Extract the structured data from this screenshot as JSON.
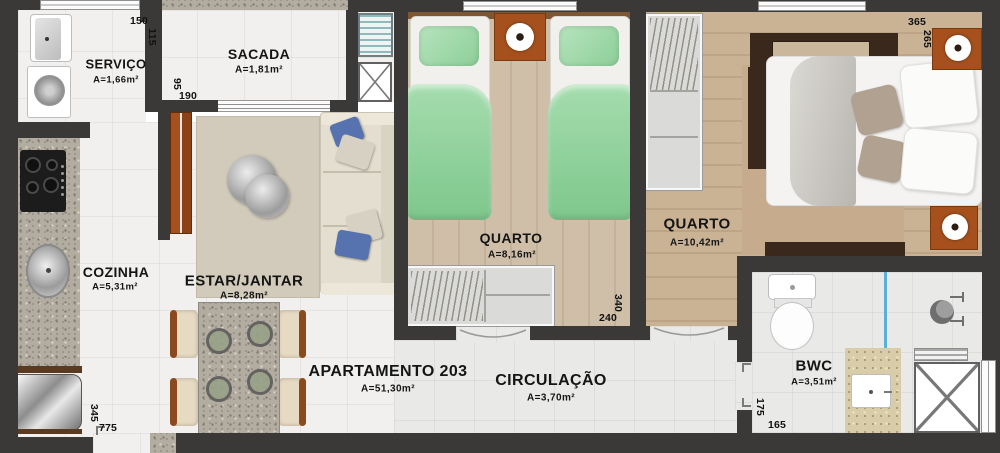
{
  "rooms": {
    "servico": {
      "name": "SERVIÇO",
      "area": "A=1,66m²"
    },
    "sacada": {
      "name": "SACADA",
      "area": "A=1,81m²"
    },
    "cozinha": {
      "name": "COZINHA",
      "area": "A=5,31m²"
    },
    "estar_jantar": {
      "name": "ESTAR/JANTAR",
      "area": "A=8,28m²"
    },
    "quarto1": {
      "name": "QUARTO",
      "area": "A=8,16m²"
    },
    "quarto2": {
      "name": "QUARTO",
      "area": "A=10,42m²"
    },
    "apartamento": {
      "name": "APARTAMENTO 203",
      "area": "A=51,30m²"
    },
    "circulacao": {
      "name": "CIRCULAÇÃO",
      "area": "A=3,70m²"
    },
    "bwc": {
      "name": "BWC",
      "area": "A=3,51m²"
    }
  },
  "dimensions_cm": {
    "servico_width": "150",
    "servico_height": "115",
    "sacada_height": "95",
    "sacada_width": "190",
    "quarto2_width": "365",
    "quarto2_height": "265",
    "quarto1_width": "240",
    "quarto1_height": "340",
    "bwc_height": "175",
    "bwc_width": "165",
    "cozinha_height": "345",
    "apartamento_width": "775"
  },
  "colors": {
    "wall": "#3a3938",
    "furniture_accent_orange": "#a6511d",
    "bedding_green": "#8ccf99",
    "shower_glass_blue": "#58b1d5",
    "wood_floor_quarto1": "#cfbfa9",
    "wood_floor_quarto2": "#cab295"
  }
}
